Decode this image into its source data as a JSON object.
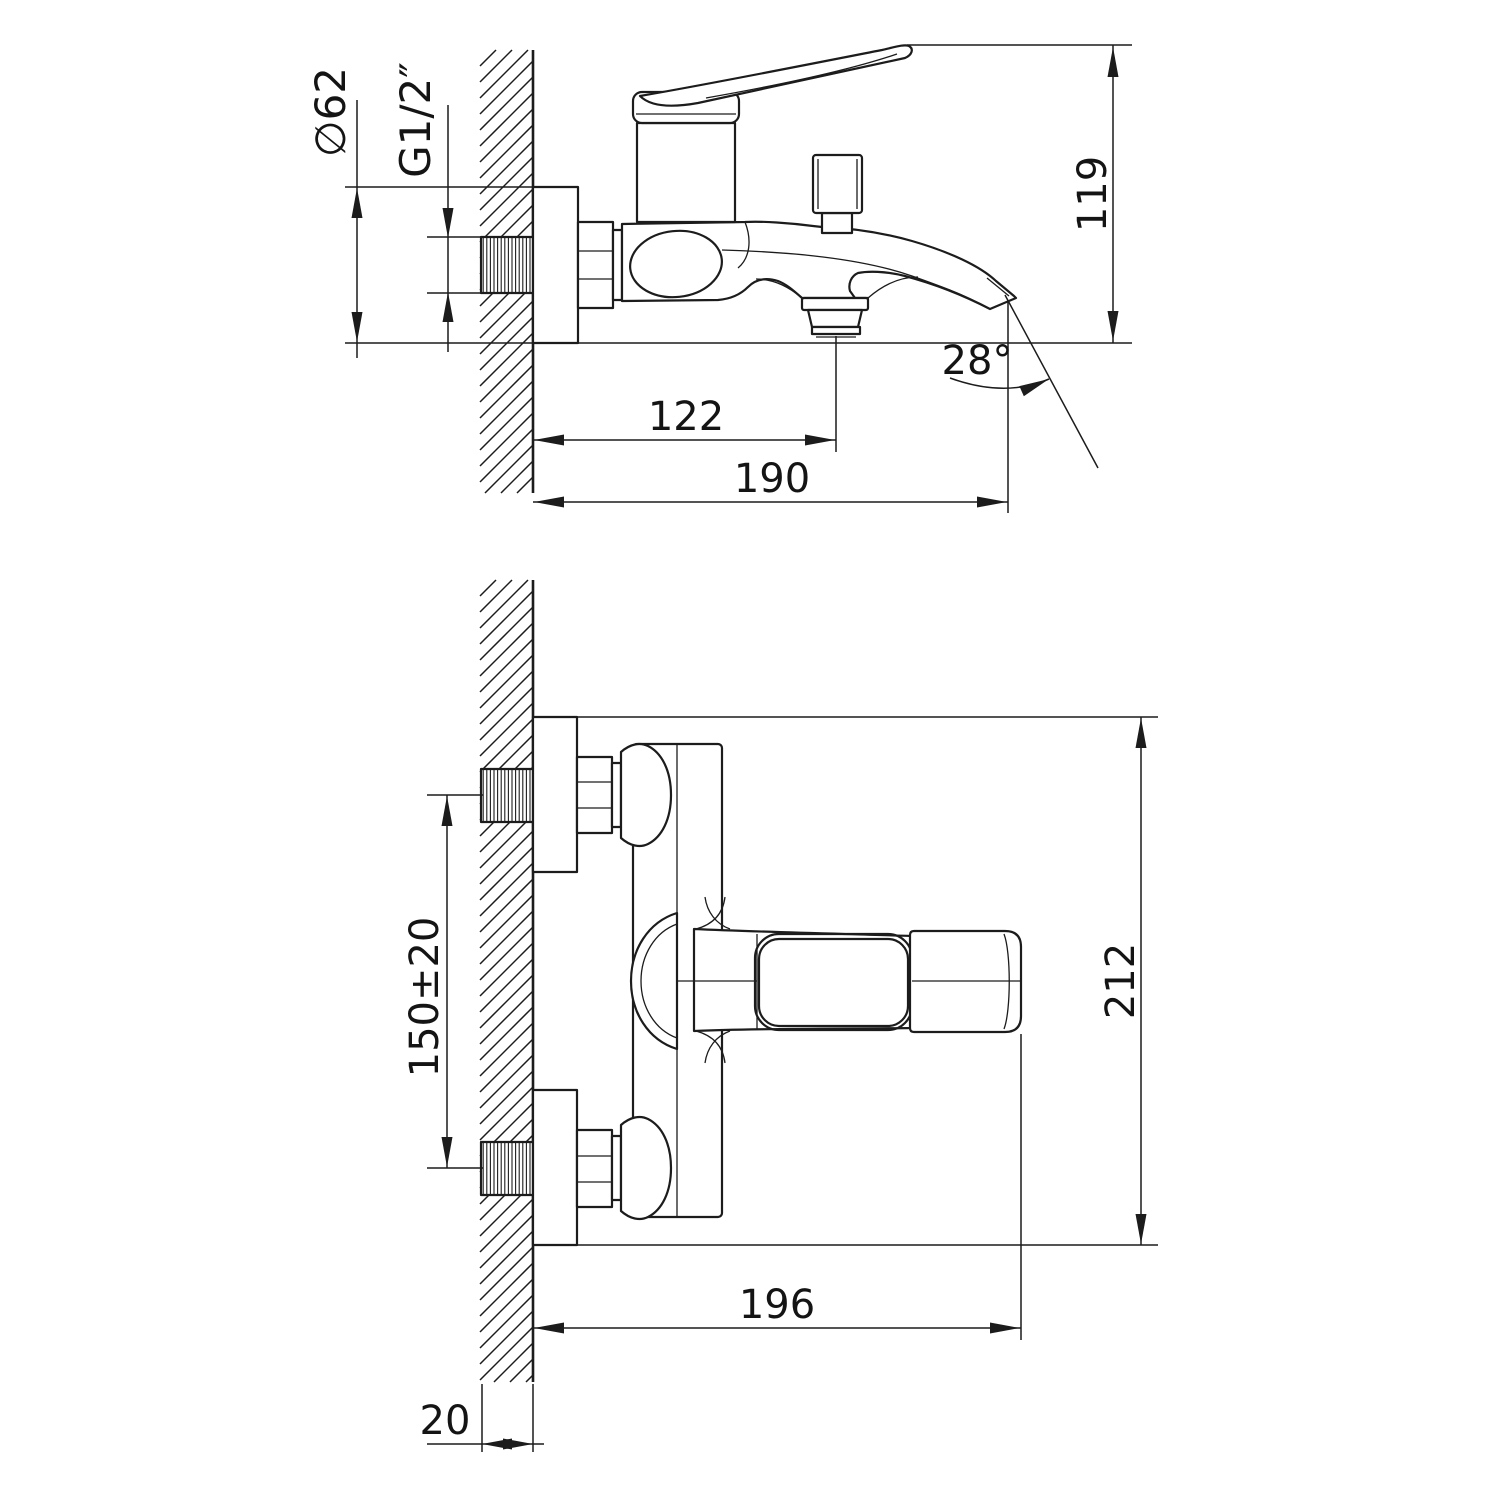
{
  "drawing": {
    "colors": {
      "ink": "#1c1c1c",
      "paper": "#ffffff"
    },
    "views": {
      "side_view": {
        "dims": {
          "plate_diameter": "∅62",
          "thread_size": "G1/2″",
          "spout_height": "119",
          "shower_outlet_offset": "122",
          "spout_reach": "190",
          "spout_angle": "28°"
        }
      },
      "front_view": {
        "dims": {
          "inlet_spacing": "150±20",
          "overall_height": "212",
          "overall_depth": "196",
          "wall_clearance": "20"
        }
      }
    }
  }
}
